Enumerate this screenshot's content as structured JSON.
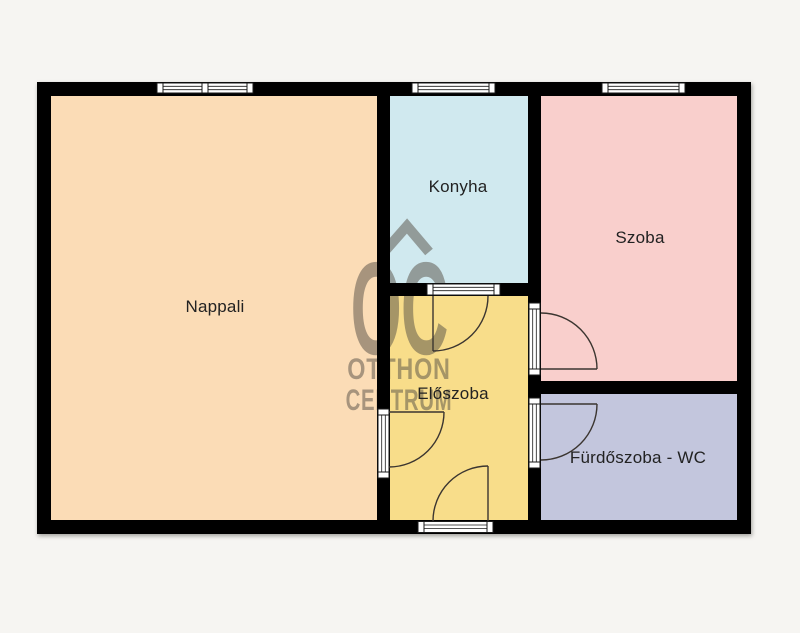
{
  "plan": {
    "rooms": [
      {
        "label": "Nappali",
        "color": "#fbdcb6"
      },
      {
        "label": "Konyha",
        "color": "#d0e9ef"
      },
      {
        "label": "Szoba",
        "color": "#f9cfcc"
      },
      {
        "label": "Előszoba",
        "color": "#f8dd8a"
      },
      {
        "label": "Fürdőszoba - WC",
        "color": "#c3c6dd"
      }
    ],
    "watermark": {
      "logo": "OC",
      "line1": "OTTHON",
      "line2": "CENTRUM",
      "color": "#554f45"
    },
    "colors": {
      "wall": "#000000",
      "background": "#f6f5f2",
      "door_line": "#3b3530",
      "window_frame": "#ffffff",
      "frame_stroke": "#1a1a1a"
    }
  }
}
